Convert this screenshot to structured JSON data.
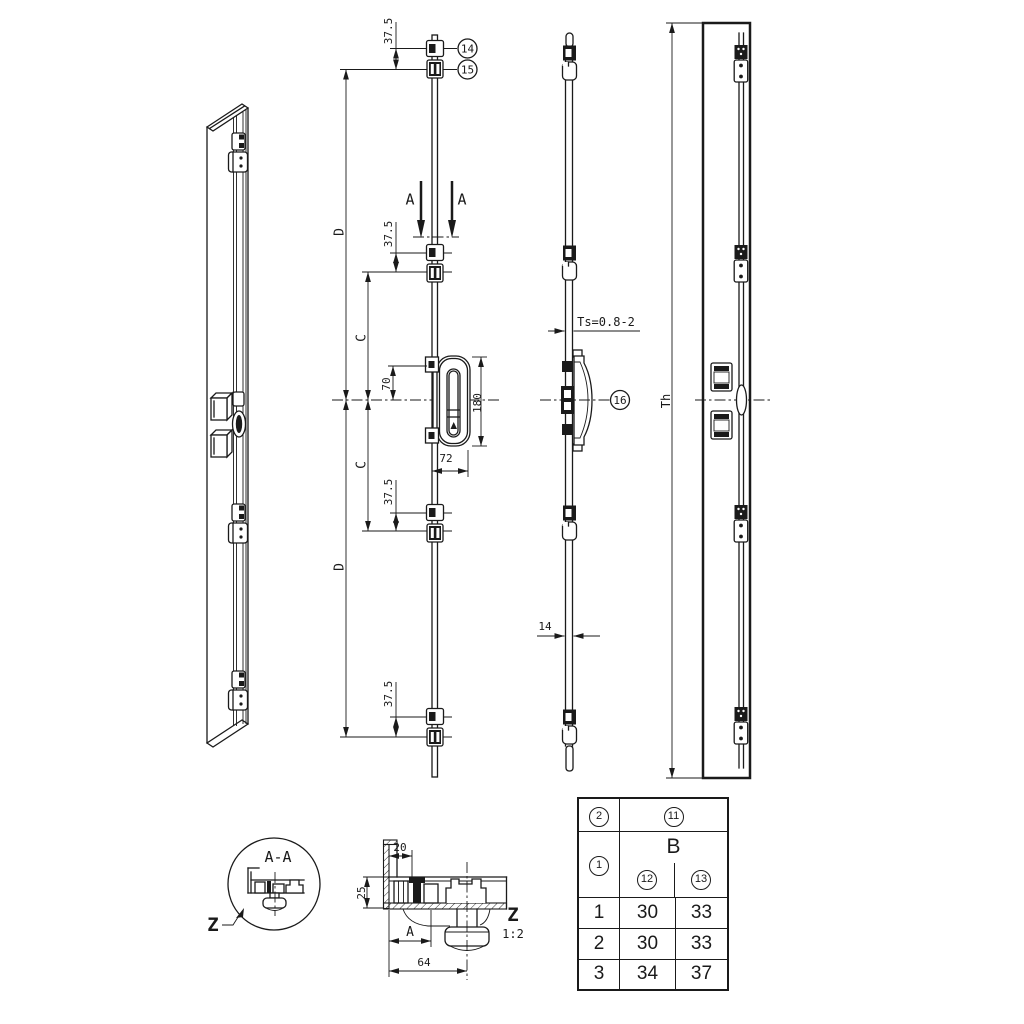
{
  "colors": {
    "line": "#1a1a1a",
    "background": "#ffffff"
  },
  "front_view": {
    "dim_end_offset": "37.5",
    "dim_d": "D",
    "dim_c": "C",
    "dim_gear_top": "70",
    "dim_faceplate": "180",
    "dim_backset": "72",
    "section_mark": "A",
    "callout_cam": "14",
    "callout_keeper": "15"
  },
  "side_view": {
    "dim_ts": "Ts=0.8-2",
    "dim_rail_width": "14",
    "callout_gear": "16"
  },
  "right_view": {
    "dim_height": "Th"
  },
  "detail_z": {
    "title": "A-A",
    "label": "Z"
  },
  "section_z": {
    "dim_20": "20",
    "dim_25": "25",
    "dim_a": "A",
    "dim_64": "64",
    "label": "Z",
    "scale": "1:2"
  },
  "table": {
    "head": {
      "item": "2",
      "group": "11",
      "row": "1",
      "b": "B",
      "col_a": "12",
      "col_b": "13"
    },
    "rows": [
      {
        "id": "1",
        "v12": "30",
        "v13": "33"
      },
      {
        "id": "2",
        "v12": "30",
        "v13": "33"
      },
      {
        "id": "3",
        "v12": "34",
        "v13": "37"
      }
    ]
  }
}
